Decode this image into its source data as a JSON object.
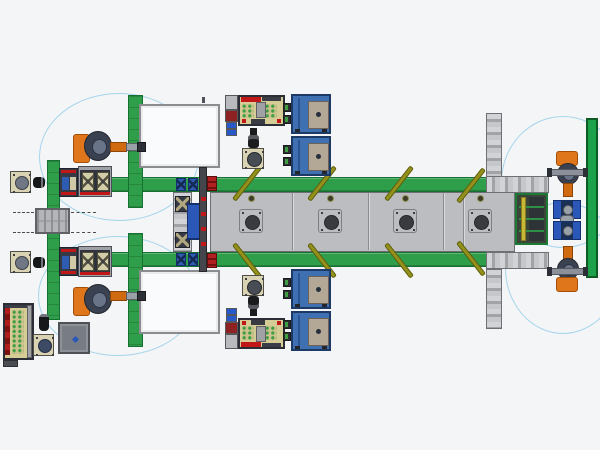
{
  "palette": {
    "bg": "#f4f5f6",
    "arc": "#a5d5ec",
    "green": "#2f9e4a",
    "green-dark": "#157031",
    "wall": "#1ca24a",
    "olive": "#93911b",
    "olive-dark": "#5f5e0d",
    "plat": "#bcbdc1",
    "plat-border": "#6e6f73",
    "seam": "#8a8b8f",
    "white-plat": "#fafbfc",
    "steel": "#c6c7cb",
    "steel-border": "#6f7073",
    "machine-blue": "#3e70b2",
    "machine-border": "#1d3a66",
    "machine-panel": "#b3a795",
    "fixture-blue": "#2b57b8",
    "fixture-border": "#14306b",
    "khaki": "#d6cd96",
    "panel-border": "#2b2e36",
    "chip": "#3f9e42",
    "red": "#c01818",
    "maroon": "#8e2222",
    "cab-blue": "#2859c8",
    "robot-orange": "#e0761c",
    "robot-arm": "#d06a10",
    "robot-body": "#3a4252",
    "link": "#9aa0a8",
    "gripper": "#2c2f36",
    "pole": "#44464c",
    "tan": "#d9d3b4",
    "tan-border": "#4f4f45",
    "dark-box": "#787d85",
    "yellow": "#c8b838",
    "black-part": "#17181a"
  },
  "scene": {
    "view": "top",
    "main_line_segments": 4,
    "segment_center_plates": 4,
    "segment_pin_holes": 4,
    "diagonal_guide_bars_top": 4,
    "diagonal_guide_bars_bottom": 4,
    "blue_process_machines": 4,
    "industrial_robots": 4,
    "white_buffer_platforms": 2,
    "circuit_control_panels": 3,
    "work_envelope_circles": 4,
    "steel_ladder_conveyors": 4,
    "tan_camera_fixtures": 3,
    "pallet_plates_left": 2
  }
}
